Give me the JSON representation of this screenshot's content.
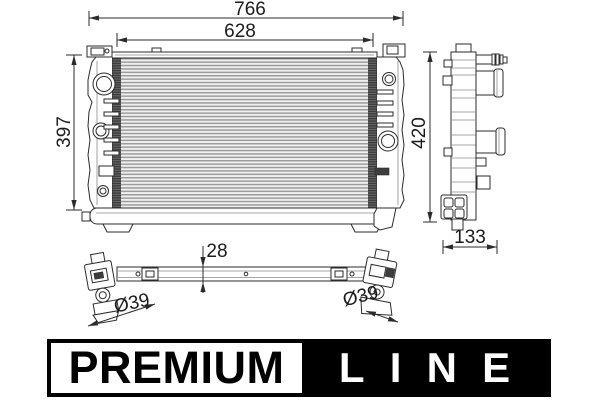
{
  "dimensions": {
    "overall_width": "766",
    "core_width": "628",
    "left_height": "397",
    "overall_height": "420",
    "depth": "133",
    "thickness": "28",
    "left_port_diameter": "Ø39",
    "right_port_diameter": "Ø39"
  },
  "logo": {
    "premium": "PREMIUM",
    "line": "LINE"
  },
  "colors": {
    "ink": "#2b2b2b",
    "fin_gray": "#9c9c9c",
    "plate_dark": "#3d3d3d",
    "logo_black": "#000000",
    "logo_white": "#ffffff",
    "background": "#ffffff"
  }
}
